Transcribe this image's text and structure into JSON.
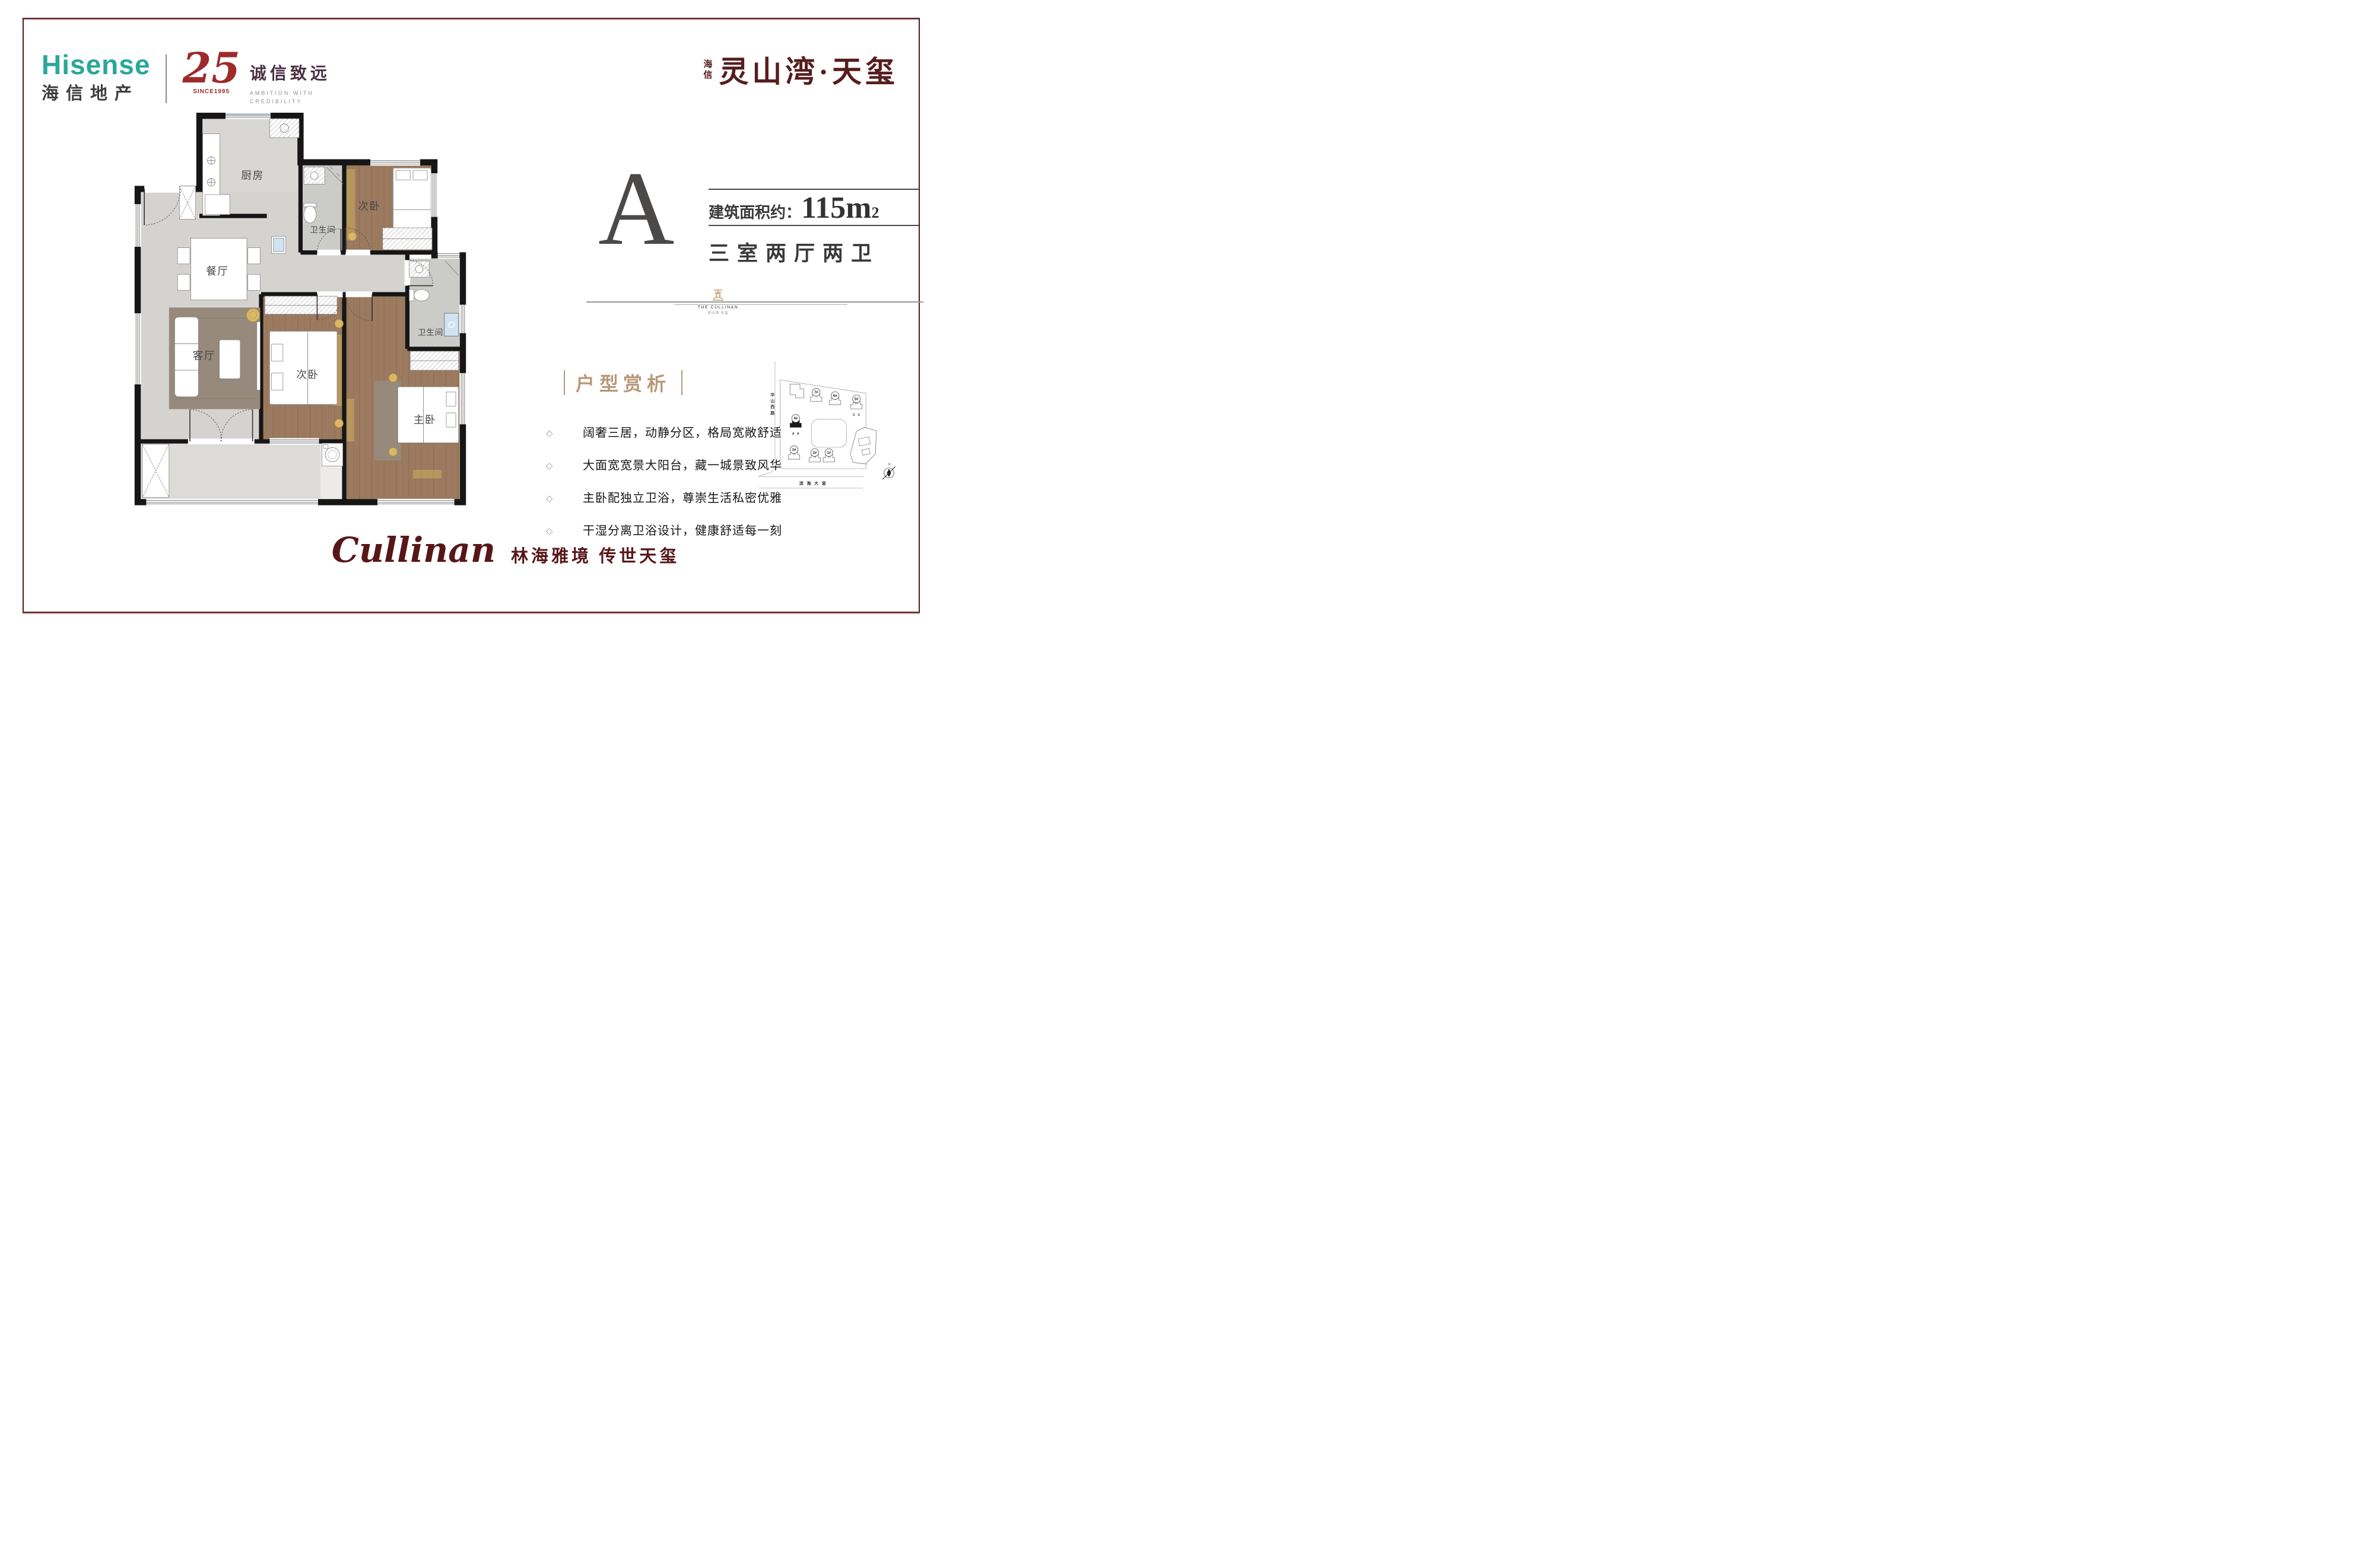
{
  "frame": {
    "border_color": "#4F1B1E"
  },
  "brand": {
    "hisense_en": "Hisense",
    "hisense_cn": "海信地产",
    "anniv_number": "25",
    "anniv_since": "SINCE1995",
    "anniv_slogan_cn": "诚信致远",
    "anniv_slogan_en1": "AMBITION WITH",
    "anniv_slogan_en2": "CREDIBILITY",
    "teal": "#2BA79C",
    "red": "#9E2A2C"
  },
  "project": {
    "prefix": "海信",
    "name": "灵山湾·天玺",
    "color": "#571D1D"
  },
  "unit": {
    "letter": "A",
    "area_label": "建筑面积约：",
    "area_value": "115m",
    "area_sup": "2",
    "rooms": "三室两厅两卫"
  },
  "emblem": {
    "line1": "THE CULLINAN",
    "line2": "灵山湾·天玺"
  },
  "analysis": {
    "title": "户型赏析",
    "bullet": "◇",
    "items": [
      "阔奢三居，动静分区，格局宽敞舒适",
      "大面宽宽景大阳台，藏一城景致风华",
      "主卧配独立卫浴，尊崇生活私密优雅",
      "干湿分离卫浴设计，健康舒适每一刻"
    ]
  },
  "floorplan": {
    "kitchen": "厨房",
    "dining": "餐厅",
    "living": "客厅",
    "bedroom_top": "次卧",
    "bedroom_mid": "次卧",
    "master": "主卧",
    "bath_top": "卫生间",
    "bath_right": "卫生间"
  },
  "sitemap": {
    "road_left": "华山西路",
    "road_bottom": "滨海大道",
    "b7": "7#",
    "b6": "6#",
    "b5": "5#",
    "b4": "4#",
    "b3": "3#",
    "b2": "2#",
    "b1": "1#",
    "unit_a": "A A",
    "unit_c": "C C",
    "north": "N"
  },
  "slogan": {
    "script": "Cullinan",
    "cn": "林海雅境 传世天玺"
  }
}
